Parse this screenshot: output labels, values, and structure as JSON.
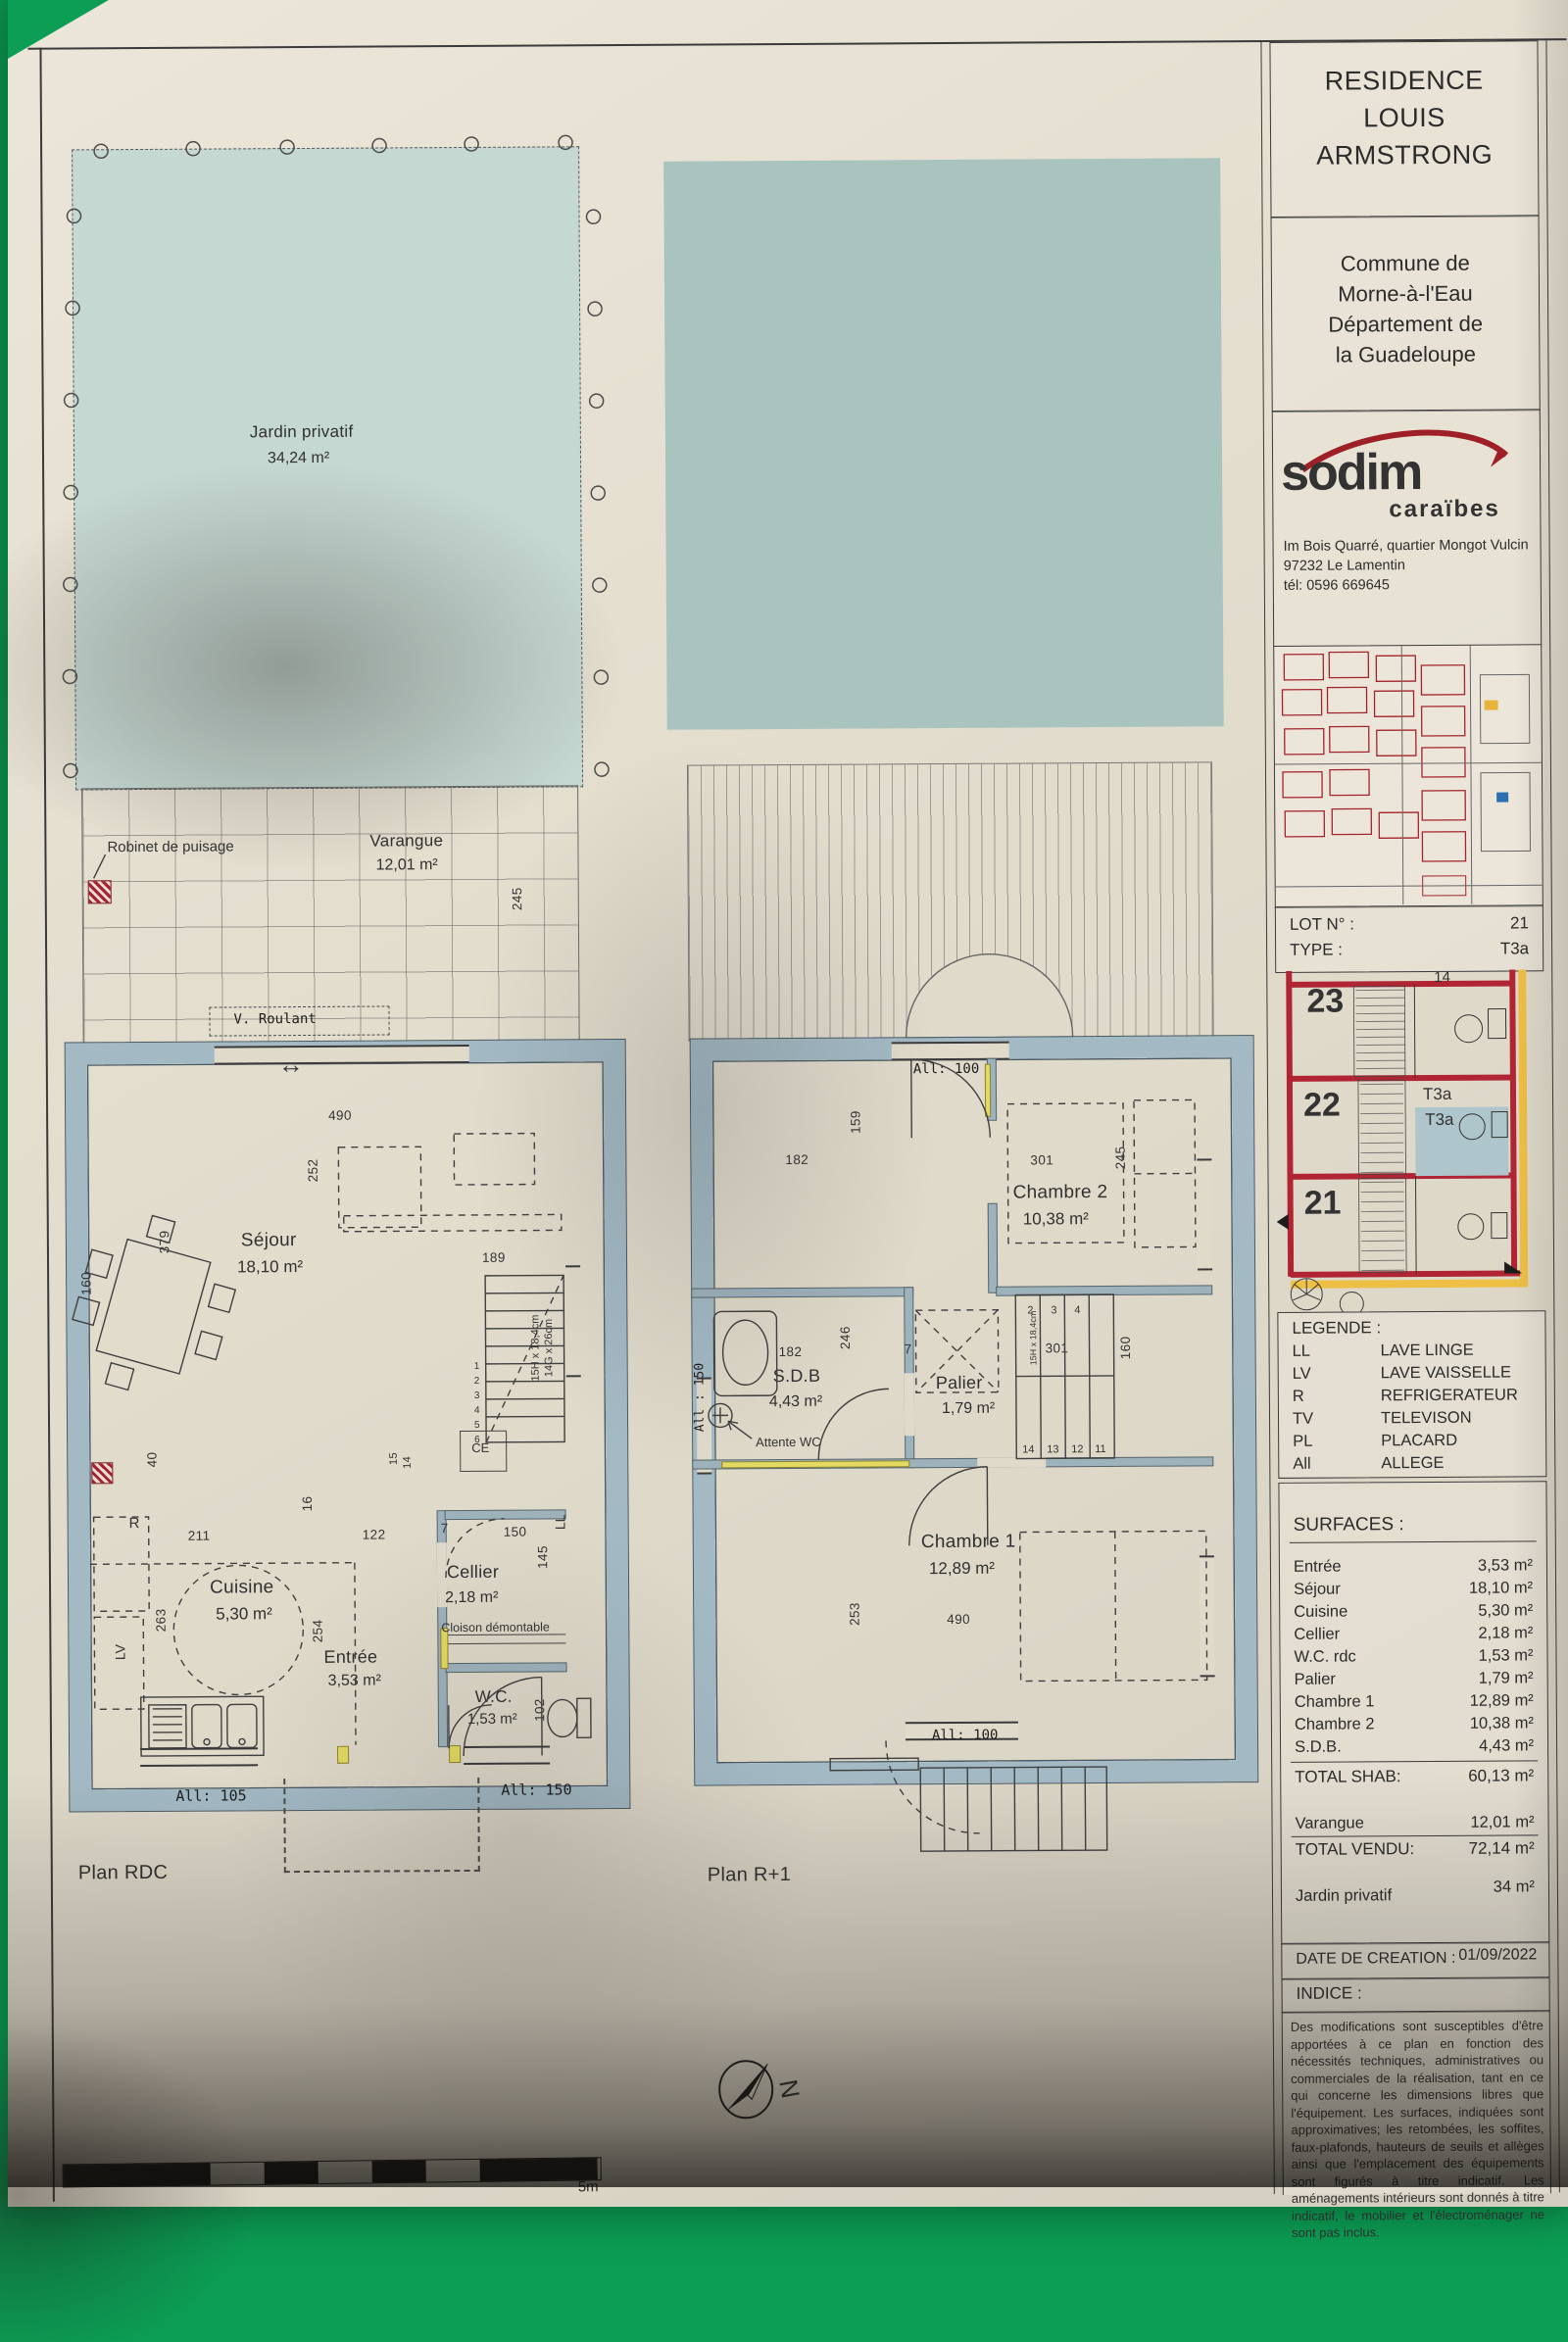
{
  "header": {
    "title_lines": [
      "RESIDENCE",
      "LOUIS",
      "ARMSTRONG"
    ],
    "commune_lines": [
      "Commune de",
      "Morne-à-l'Eau",
      "Département de",
      "la Guadeloupe"
    ]
  },
  "company": {
    "logo_main": "sodim",
    "logo_sub": "caraïbes",
    "address": [
      "Im Bois Quarré, quartier Mongot Vulcin",
      "97232 Le Lamentin",
      "tél: 0596 669645"
    ]
  },
  "lot": {
    "lot_label": "LOT N° :",
    "lot_value": "21",
    "type_label": "TYPE :",
    "type_value": "T3a"
  },
  "siteplan": {
    "lot_numbers": [
      "23",
      "22",
      "21"
    ],
    "type_tags": [
      "T3a",
      "T3a"
    ],
    "num14": "14"
  },
  "legend": {
    "title": "LEGENDE :",
    "items": [
      {
        "code": "LL",
        "label": "LAVE LINGE"
      },
      {
        "code": "LV",
        "label": "LAVE VAISSELLE"
      },
      {
        "code": "R",
        "label": "REFRIGERATEUR"
      },
      {
        "code": "TV",
        "label": "TELEVISON"
      },
      {
        "code": "PL",
        "label": "PLACARD"
      },
      {
        "code": "All",
        "label": "ALLEGE"
      }
    ]
  },
  "surfaces": {
    "title": "SURFACES :",
    "rows": [
      {
        "name": "Entrée",
        "area": "3,53 m²"
      },
      {
        "name": "Séjour",
        "area": "18,10 m²"
      },
      {
        "name": "Cuisine",
        "area": "5,30 m²"
      },
      {
        "name": "Cellier",
        "area": "2,18 m²"
      },
      {
        "name": "W.C. rdc",
        "area": "1,53 m²"
      },
      {
        "name": "Palier",
        "area": "1,79 m²"
      },
      {
        "name": "Chambre 1",
        "area": "12,89 m²"
      },
      {
        "name": "Chambre 2",
        "area": "10,38 m²"
      },
      {
        "name": "S.D.B.",
        "area": "4,43 m²"
      }
    ],
    "total_shab_label": "TOTAL SHAB:",
    "total_shab_value": "60,13 m²",
    "varangue_label": "Varangue",
    "varangue_value": "12,01 m²",
    "total_vendu_label": "TOTAL VENDU:",
    "total_vendu_value": "72,14 m²",
    "jardin_label": "Jardin privatif",
    "jardin_value": "34 m²"
  },
  "footer": {
    "date_label": "DATE DE CREATION :",
    "date_value": "01/09/2022",
    "indice_label": "INDICE :",
    "disclaimer": "Des modifications sont susceptibles d'être apportées à ce plan en fonction des nécessités techniques, administratives ou commerciales de la réalisation, tant en ce qui concerne les dimensions libres que l'équipement. Les surfaces, indiquées sont approximatives; les retombées, les soffites, faux-plafonds, hauteurs de seuils et allèges ainsi que l'emplacement des équipements sont figurés à titre indicatif. Les aménagements intérieurs sont donnés à titre indicatif, le mobilier et l'électroménager ne sont pas inclus."
  },
  "plans": {
    "rdc": {
      "label": "Plan RDC",
      "jardin_name": "Jardin privatif",
      "jardin_area": "34,24 m²",
      "varangue_name": "Varangue",
      "varangue_area": "12,01 m²",
      "sejour_name": "Séjour",
      "sejour_area": "18,10 m²",
      "cuisine_name": "Cuisine",
      "cuisine_area": "5,30 m²",
      "cellier_name": "Cellier",
      "cellier_area": "2,18 m²",
      "entree_name": "Entrée",
      "entree_area": "3,53 m²",
      "wc_name": "W.C.",
      "wc_area": "1,53 m²",
      "robinet": "Robinet de puisage",
      "v_roulant": "V. Roulant",
      "cloison": "Cloison démontable",
      "ce": "CE",
      "all105": "All: 105",
      "all150": "All: 150",
      "r": "R",
      "lv": "LV",
      "ll": "LL",
      "stair_note1": "15H x 18,4cm",
      "stair_note2": "14G x 26cm",
      "stair_nums": [
        "1",
        "2",
        "3",
        "4",
        "5",
        "6"
      ],
      "d15": "15",
      "d14": "14",
      "dims": {
        "d490": "490",
        "d252": "252",
        "d379": "379",
        "d160": "160",
        "d189": "189",
        "d245": "245",
        "d211": "211",
        "d122": "122",
        "d16": "16",
        "d40": "40",
        "d263": "263",
        "d254": "254",
        "d150": "150",
        "d145": "145",
        "d7": "7",
        "d102": "102"
      }
    },
    "r1": {
      "label": "Plan R+1",
      "chambre2_name": "Chambre 2",
      "chambre2_area": "10,38 m²",
      "sdb_name": "S.D.B",
      "sdb_area": "4,43 m²",
      "palier_name": "Palier",
      "palier_area": "1,79 m²",
      "chambre1_name": "Chambre 1",
      "chambre1_area": "12,89 m²",
      "attente": "Attente WC",
      "all100_top": "All: 100",
      "all100_bottom": "All: 100",
      "all150": "All : 150",
      "stair_note": "15H x 18,4cm",
      "stair_top": [
        "2",
        "3",
        "4"
      ],
      "stair_bottom": [
        "14",
        "13",
        "12",
        "11"
      ],
      "dims": {
        "d159": "159",
        "d182a": "182",
        "d301a": "301",
        "d245": "245",
        "d182b": "182",
        "d246": "246",
        "d301b": "301",
        "d7": "7",
        "d253": "253",
        "d490": "490",
        "d160": "160"
      }
    }
  },
  "compass": {
    "north": "N"
  },
  "scalebar": {
    "label": "5m"
  }
}
